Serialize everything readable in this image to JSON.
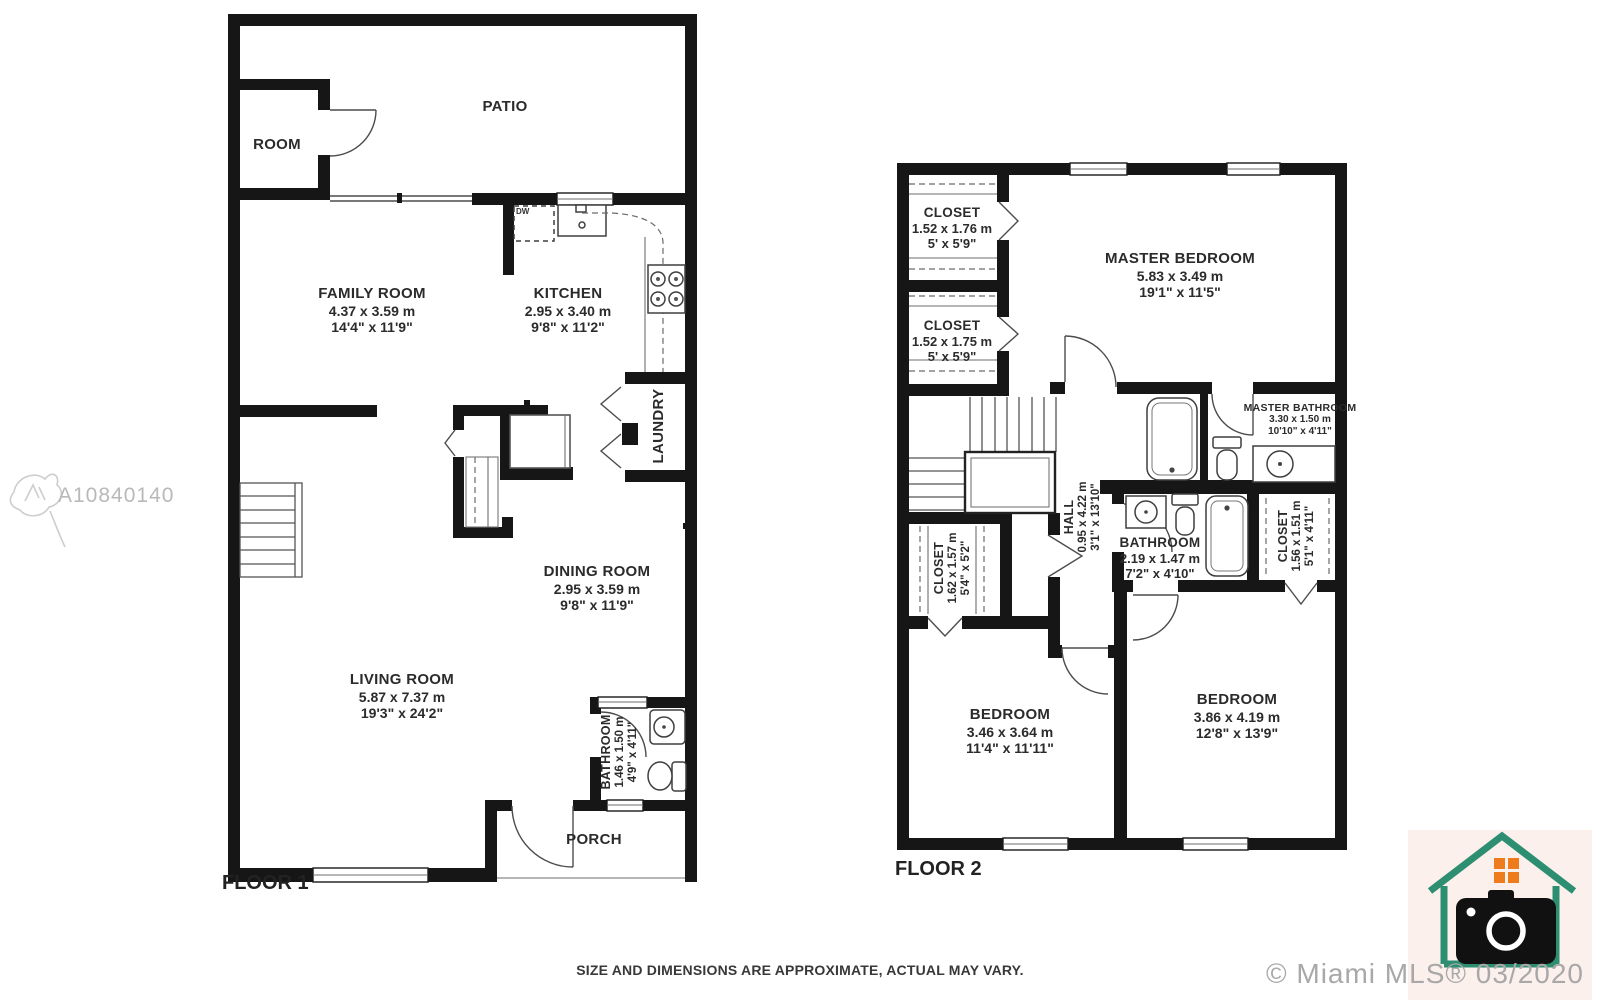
{
  "watermark": {
    "mls_id": "A10840140"
  },
  "footer": {
    "disclaimer": "SIZE AND DIMENSIONS ARE APPROXIMATE, ACTUAL MAY VARY.",
    "copyright": "© Miami MLS® 03/2020"
  },
  "floor1": {
    "label": "FLOOR 1",
    "appliances": {
      "dishwasher": "DW"
    },
    "rooms": {
      "room": {
        "name": "ROOM"
      },
      "patio": {
        "name": "PATIO"
      },
      "family_room": {
        "name": "FAMILY ROOM",
        "metric": "4.37 x 3.59 m",
        "imperial": "14'4\" x 11'9\""
      },
      "kitchen": {
        "name": "KITCHEN",
        "metric": "2.95 x 3.40 m",
        "imperial": "9'8\" x 11'2\""
      },
      "laundry": {
        "name": "LAUNDRY"
      },
      "dining_room": {
        "name": "DINING ROOM",
        "metric": "2.95 x 3.59 m",
        "imperial": "9'8\" x 11'9\""
      },
      "living_room": {
        "name": "LIVING ROOM",
        "metric": "5.87 x 7.37 m",
        "imperial": "19'3\" x 24'2\""
      },
      "bathroom": {
        "name": "BATHROOM",
        "metric": "1.46 x 1.50 m",
        "imperial": "4'9\" x 4'11\""
      },
      "porch": {
        "name": "PORCH"
      }
    }
  },
  "floor2": {
    "label": "FLOOR 2",
    "rooms": {
      "closet_top_1": {
        "name": "CLOSET",
        "metric": "1.52 x 1.76 m",
        "imperial": "5' x 5'9\""
      },
      "closet_top_2": {
        "name": "CLOSET",
        "metric": "1.52 x 1.75 m",
        "imperial": "5' x 5'9\""
      },
      "master_bedroom": {
        "name": "MASTER BEDROOM",
        "metric": "5.83 x 3.49 m",
        "imperial": "19'1\" x 11'5\""
      },
      "master_bathroom": {
        "name": "MASTER BATHROOM",
        "metric": "3.30 x 1.50 m",
        "imperial": "10'10\" x 4'11\""
      },
      "hall": {
        "name": "HALL",
        "metric": "0.95 x 4.22 m",
        "imperial": "3'1\" x 13'10\""
      },
      "bathroom": {
        "name": "BATHROOM",
        "metric": "2.19 x 1.47 m",
        "imperial": "7'2\" x 4'10\""
      },
      "closet_left": {
        "name": "CLOSET",
        "metric": "1.62 x 1.57 m",
        "imperial": "5'4\" x 5'2\""
      },
      "closet_right": {
        "name": "CLOSET",
        "metric": "1.56 x 1.51 m",
        "imperial": "5'1\" x 4'11\""
      },
      "bedroom_left": {
        "name": "BEDROOM",
        "metric": "3.46 x 3.64 m",
        "imperial": "11'4\" x 11'11\""
      },
      "bedroom_right": {
        "name": "BEDROOM",
        "metric": "3.86 x 4.19 m",
        "imperial": "12'8\" x 13'9\""
      }
    }
  },
  "colors": {
    "wall": "#161616",
    "line": "#4c4c4c",
    "watermark": "#b9b9b9",
    "copyright": "#a8a8a8",
    "logo_green": "#2e8e71",
    "logo_orange": "#ee7c1d",
    "logo_background": "#fcf0ec"
  }
}
